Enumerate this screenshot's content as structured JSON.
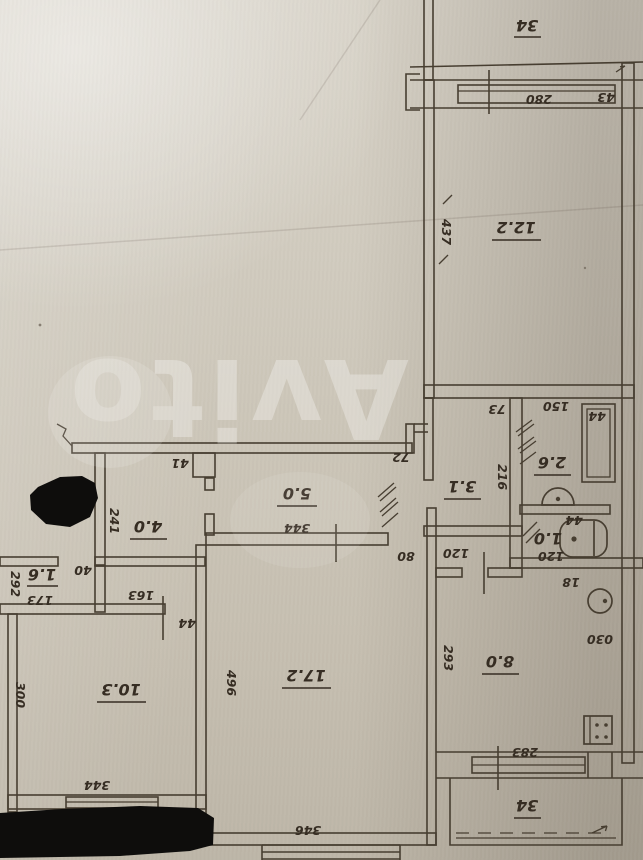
{
  "colors": {
    "ink": "#473e31",
    "text_ink": "#362d23",
    "paper_light": "#d8d3c8",
    "paper_dark": "#bdb6a8",
    "watermark": "#ffffff",
    "redaction": "#0e0d0c"
  },
  "watermark": {
    "text": "Avito"
  },
  "labels": {
    "rooms": {
      "balcony_top": "34",
      "room_12_2": "12.2",
      "bath_2_6": "2.6",
      "hall_3_1": "3.1",
      "wc_1_0": "1.0",
      "corridor_5_0": "5.0",
      "hall_4_0": "4.0",
      "closet_1_6": "1.6",
      "room_10_3": "10.3",
      "room_17_2": "17.2",
      "kitchen_8_0": "8.0",
      "balcony_bottom": "34"
    },
    "dims": {
      "w280": "280",
      "w43": "43",
      "w437": "437",
      "w73": "73",
      "w150": "150",
      "w44_bath": "44",
      "w216": "216",
      "w44_wc": "44",
      "w120_wc": "120",
      "w72": "72",
      "w41": "41",
      "w344_hall": "344",
      "w80": "80",
      "w120_kitchen": "120",
      "w241": "241",
      "w40": "40",
      "w292": "292",
      "w173": "173",
      "w163": "163",
      "w44_closet": "44",
      "w300": "300",
      "w344_window": "344",
      "w496": "496",
      "w346": "346",
      "w293": "293",
      "w030": "030",
      "w18": "18",
      "w283": "283"
    }
  }
}
